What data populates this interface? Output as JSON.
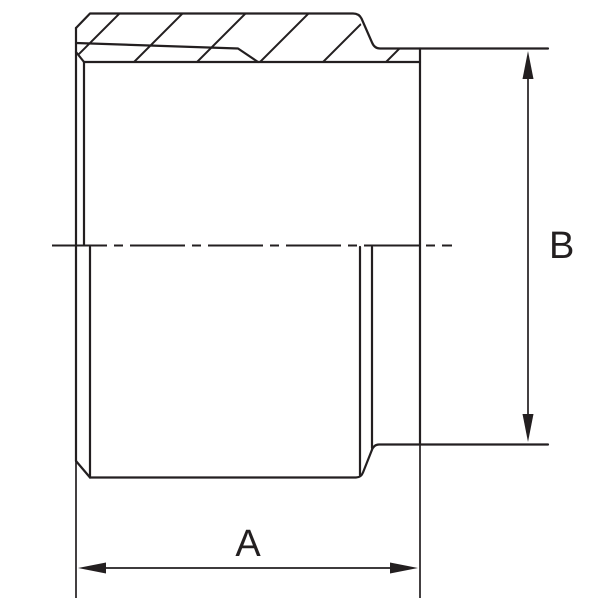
{
  "drawing": {
    "dimension_labels": {
      "a": "A",
      "b": "B"
    },
    "colors": {
      "line": "#231f20",
      "background": "#ffffff"
    }
  }
}
